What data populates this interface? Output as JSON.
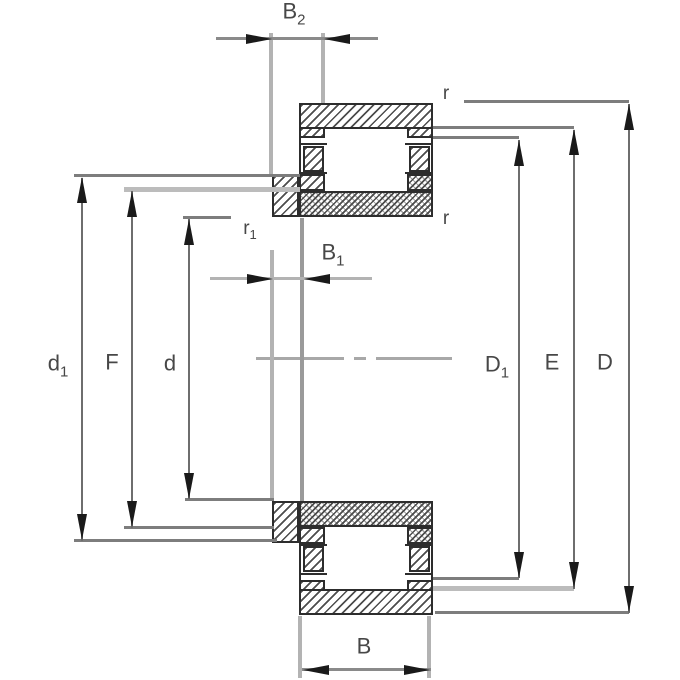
{
  "diagram_type": "cylindrical-roller-bearing-cross-section-dimension-drawing",
  "labels": {
    "b2": {
      "base": "B",
      "sub": "2"
    },
    "b1": {
      "base": "B",
      "sub": "1"
    },
    "b": {
      "base": "B",
      "sub": ""
    },
    "r_top": {
      "base": "r",
      "sub": ""
    },
    "r_bottom": {
      "base": "r",
      "sub": ""
    },
    "r1": {
      "base": "r",
      "sub": "1"
    },
    "d1": {
      "base": "d",
      "sub": "1"
    },
    "f": {
      "base": "F",
      "sub": ""
    },
    "d": {
      "base": "d",
      "sub": ""
    },
    "d1_outer": {
      "base": "D",
      "sub": "1"
    },
    "e": {
      "base": "E",
      "sub": ""
    },
    "d_outer": {
      "base": "D",
      "sub": ""
    }
  },
  "colors": {
    "background": "#ffffff",
    "outline": "#2d2d2d",
    "hatch": "#4d4d4d",
    "dim_line": "#8a8a8a",
    "dim_vertical": "#6e6e6e",
    "connector": "#7d7d7d",
    "connector_light": "#bcbcbc",
    "ext_line": "#b3b3b3",
    "ext_line_dark": "#9a9a9a",
    "arrow": "#1a1a1a",
    "label": "#474747",
    "centerline": "#a8a8a8"
  }
}
